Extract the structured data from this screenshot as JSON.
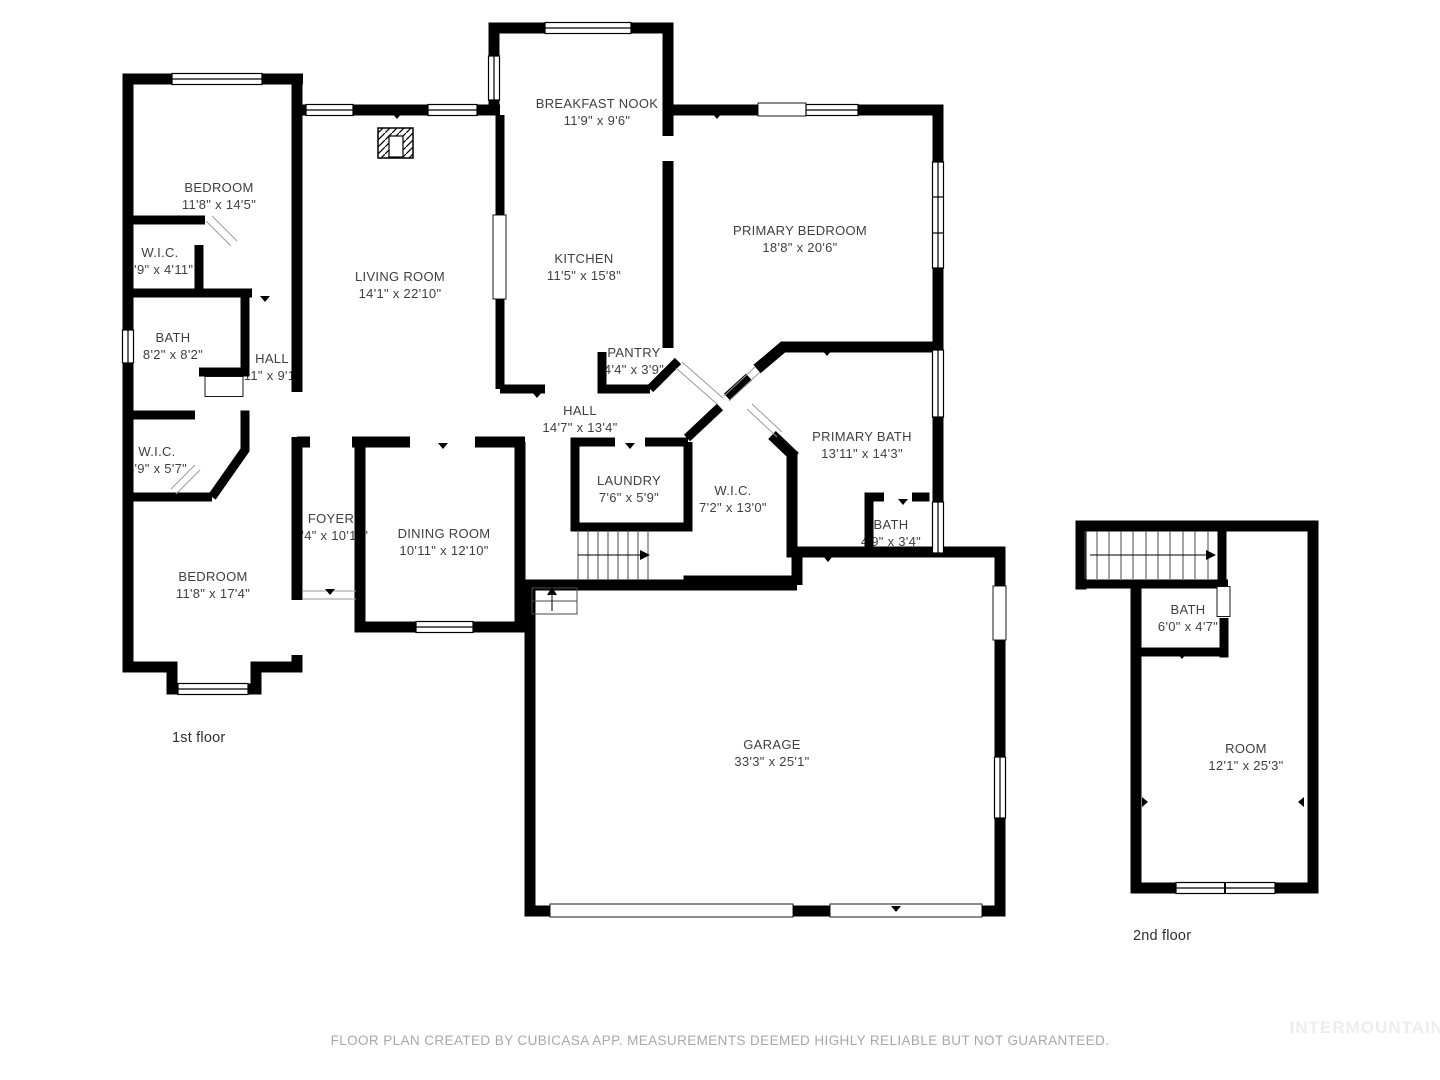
{
  "rooms": [
    {
      "name": "BEDROOM",
      "dims": "11'8\" x 14'5\""
    },
    {
      "name": "W.I.C.",
      "dims": "4'9\" x 4'11\""
    },
    {
      "name": "BATH",
      "dims": "8'2\" x 8'2\""
    },
    {
      "name": "HALL",
      "dims": "11\" x 9'1\""
    },
    {
      "name": "W.I.C.",
      "dims": "4'9\" x 5'7\""
    },
    {
      "name": "BEDROOM",
      "dims": "11'8\" x 17'4\""
    },
    {
      "name": "FOYER",
      "dims": "4'4\" x 10'11\""
    },
    {
      "name": "DINING ROOM",
      "dims": "10'11\" x 12'10\""
    },
    {
      "name": "LIVING ROOM",
      "dims": "14'1\" x 22'10\""
    },
    {
      "name": "BREAKFAST NOOK",
      "dims": "11'9\" x 9'6\""
    },
    {
      "name": "KITCHEN",
      "dims": "11'5\" x 15'8\""
    },
    {
      "name": "PANTRY",
      "dims": "4'4\" x 3'9\""
    },
    {
      "name": "HALL",
      "dims": "14'7\" x 13'4\""
    },
    {
      "name": "LAUNDRY",
      "dims": "7'6\" x 5'9\""
    },
    {
      "name": "W.I.C.",
      "dims": "7'2\" x 13'0\""
    },
    {
      "name": "PRIMARY BEDROOM",
      "dims": "18'8\" x 20'6\""
    },
    {
      "name": "PRIMARY BATH",
      "dims": "13'11\" x 14'3\""
    },
    {
      "name": "BATH",
      "dims": "4'9\" x 3'4\""
    },
    {
      "name": "GARAGE",
      "dims": "33'3\" x 25'1\""
    },
    {
      "name": "BATH",
      "dims": "6'0\" x 4'7\""
    },
    {
      "name": "ROOM",
      "dims": "12'1\" x 25'3\""
    }
  ],
  "floor_labels": {
    "first": "1st floor",
    "second": "2nd floor"
  },
  "footer": {
    "disclaimer": "FLOOR PLAN CREATED BY CUBICASA APP. MEASUREMENTS DEEMED HIGHLY RELIABLE BUT NOT GUARANTEED."
  },
  "watermark": "INTERMOUNTAIN",
  "colors": {
    "wall": "#000000",
    "label": "#3f3f3f",
    "disclaimer": "#a8a8a8",
    "watermark": "#ededed",
    "background": "#ffffff"
  }
}
